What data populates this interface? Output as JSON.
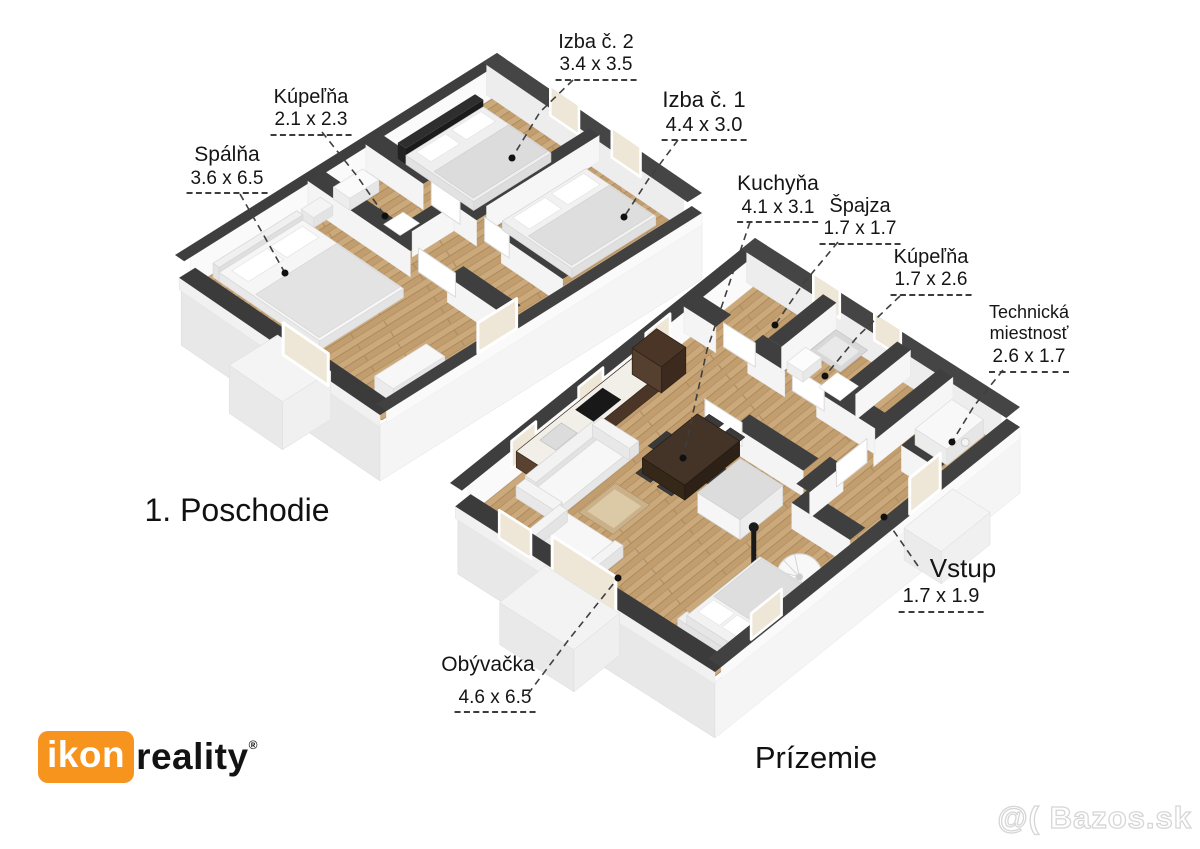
{
  "floors": [
    {
      "title": "1. Poschodie",
      "rooms": [
        {
          "id": "spalna",
          "name": "Spálňa",
          "dims": "3.6 x 6.5"
        },
        {
          "id": "kupelna",
          "name": "Kúpeľňa",
          "dims": "2.1 x 2.3"
        },
        {
          "id": "izba2",
          "name": "Izba č. 2",
          "dims": "3.4 x 3.5"
        },
        {
          "id": "izba1",
          "name": "Izba č. 1",
          "dims": "4.4 x 3.0"
        }
      ]
    },
    {
      "title": "Prízemie",
      "rooms": [
        {
          "id": "kuchyna",
          "name": "Kuchyňa",
          "dims": "4.1 x 3.1"
        },
        {
          "id": "spajza",
          "name": "Špajza",
          "dims": "1.7 x 1.7"
        },
        {
          "id": "kupelna",
          "name": "Kúpeľňa",
          "dims": "1.7 x 2.6"
        },
        {
          "id": "technicka",
          "name": "Technická miestnosť",
          "dims": "2.6 x 1.7"
        },
        {
          "id": "vstup",
          "name": "Vstup",
          "dims": "1.7 x 1.9"
        },
        {
          "id": "obyvacka",
          "name": "Obývačka",
          "dims": "4.6 x 6.5"
        }
      ]
    }
  ],
  "branding": {
    "agency_prefix": "ikon",
    "agency_suffix": "reality",
    "registered": "®",
    "watermark": "@( Bazos.sk"
  },
  "colors": {
    "wall_top": "#3f3f3f",
    "floor_wood": "#c9a678",
    "accent_orange": "#f7941e"
  }
}
